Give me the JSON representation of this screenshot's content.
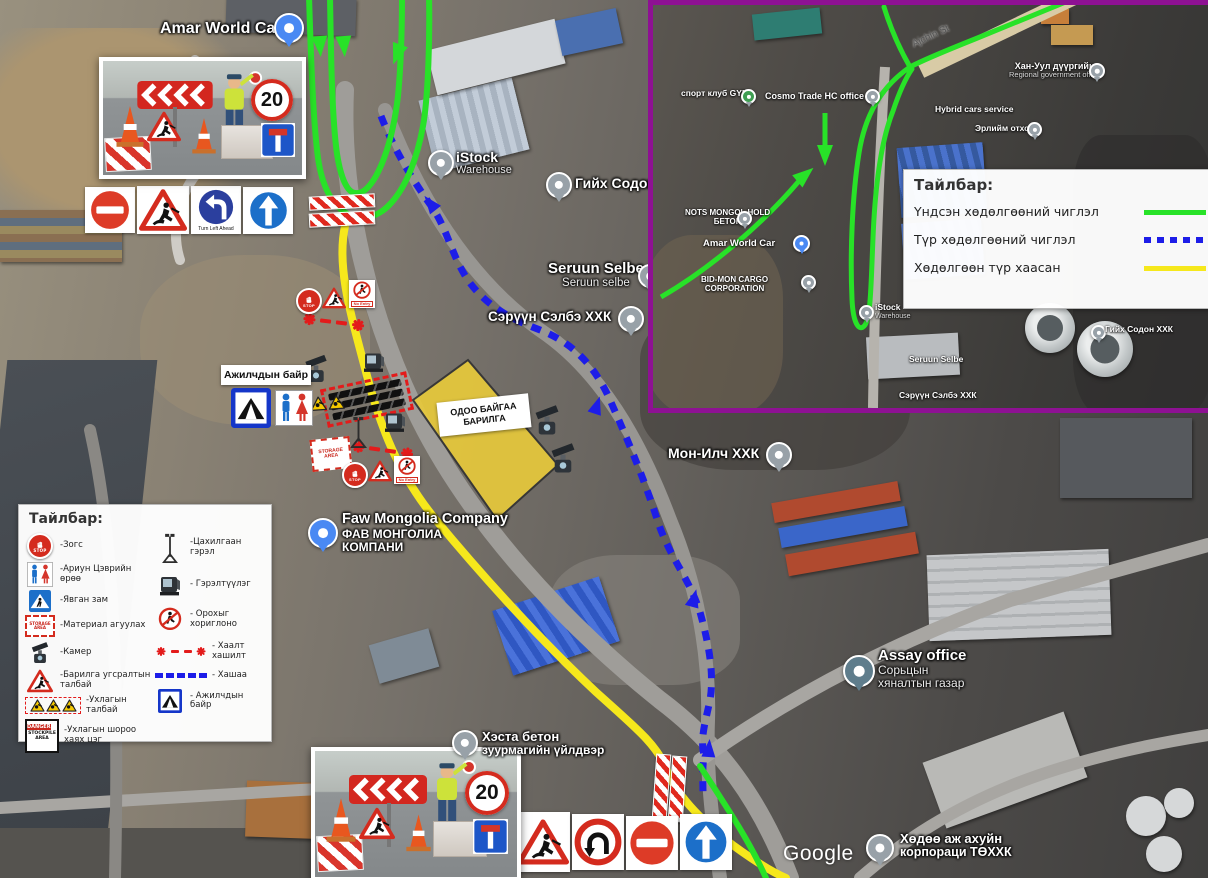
{
  "colors": {
    "main_route_green": "#28e228",
    "temp_route_blue": "#1d1de8",
    "closed_route_yellow": "#f6e81c",
    "inset_border_purple": "#8e1193",
    "barrier_red": "#e31b1b"
  },
  "inset_legend": {
    "title": "Тайлбар:",
    "items": [
      {
        "label": "Үндсэн хөдөлгөөний чиглэл",
        "style": "green-solid"
      },
      {
        "label": "Түр хөдөлгөөний чиглэл",
        "style": "blue-dashed"
      },
      {
        "label": "Хөдөлгөөн түр хаасан",
        "style": "yellow-solid"
      }
    ]
  },
  "legend": {
    "title": "Тайлбар:",
    "left": [
      {
        "icon": "stop-icon",
        "label": "-Зогс"
      },
      {
        "icon": "toilet-icon",
        "label": "-Ариун Цэврийн өрөө"
      },
      {
        "icon": "crosswalk-icon",
        "label": "-Явган зам"
      },
      {
        "icon": "material-storage-icon",
        "label": "-Материал агуулах"
      },
      {
        "icon": "camera-icon",
        "label": "-Камер"
      },
      {
        "icon": "roadwork-icon",
        "label": "-Барилга угсралтын талбай"
      },
      {
        "icon": "excavation-triangles-icon",
        "label": "-Ухлагын талбай"
      },
      {
        "icon": "stockpile-icon",
        "label": "-Ухлагын шороо хаях цэг"
      }
    ],
    "right": [
      {
        "icon": "light-tower-icon",
        "label": "-Цахилгаан гэрэл"
      },
      {
        "icon": "floodlight-icon",
        "label": "- Гэрэлтүүлэг"
      },
      {
        "icon": "no-pedestrian-icon",
        "label": "- Орохыг хориглоно"
      },
      {
        "icon": "barrier-line-icon",
        "label": "- Хаалт хашилт"
      },
      {
        "icon": "fence-line-icon",
        "label": "- Хашаа"
      },
      {
        "icon": "workers-camp-icon",
        "label": "- Ажилчдын байр"
      }
    ]
  },
  "map_labels": {
    "amar": "Amar World Car",
    "istock": "iStock",
    "istock_sub": "Warehouse",
    "giikh": "Гийх Содон",
    "seruun_en": "Seruun Selbe",
    "seruun_en_sub": "Seruun selbe",
    "seruun_mn": "Сэрүүн Сэлбэ ХХК",
    "mon_ilch": "Мон-Илч ХХК",
    "faw_en": "Faw Mongolia Company",
    "faw_mn1": "ФАВ МОНГОЛИА",
    "faw_mn2": "КОМПАНИ",
    "assay_en": "Assay office",
    "assay_mn1": "Сорьцын",
    "assay_mn2": "хяналтын газар",
    "khesta1": "Хэста бетон",
    "khesta2": "зуурмагийн үйлдвэр",
    "khodoo1": "Хөдөө аж ахуйн",
    "khodoo2": "корпораци ТӨХХК",
    "google": "Google"
  },
  "inset_labels": {
    "street": "Ajchin St",
    "sport_club": "спорт клуб GYM",
    "cosmo": "Cosmo Trade HC office",
    "nots1": "NOTS MONGOL HOLD",
    "nots2": "БЕТОН",
    "amar": "Amar World Car",
    "bidmon1": "BID-MON CARGO",
    "bidmon2": "CORPORATION",
    "khanuul1": "Хан-Уул дүүргийн",
    "khanuul2": "Regional government office",
    "hybrid": "Hybrid cars service",
    "erliim": "Эрлийм отхон",
    "istock": "iStock",
    "istock_sub": "Warehouse",
    "giikh": "Гийх Содон ХХК",
    "seruun_en": "Seruun Selbe",
    "seruun_mn": "Сэрүүн Сэлбэ ХХК"
  },
  "overlays": {
    "existing_building1": "ОДОО БАЙГАА",
    "existing_building2": "БАРИЛГА",
    "workers_camp": "Ажилчдын байр"
  },
  "signs": {
    "stop": "STOP",
    "speed_limit": "20",
    "turn_left_caption": "Turn Left Ahead",
    "no_entry_caption": "No Entry",
    "storage_area": "STORAGE AREA",
    "danger": "DANGER",
    "stockpile1": "STOCKPILE",
    "stockpile2": "AREA"
  }
}
